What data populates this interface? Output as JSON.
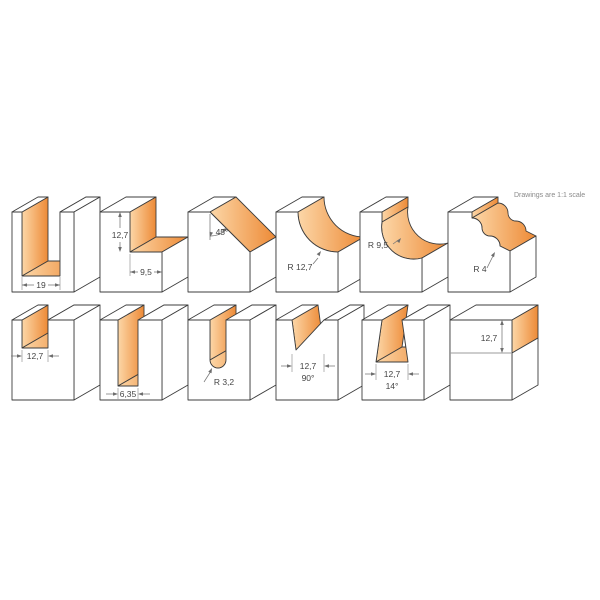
{
  "note": "Drawings are 1:1 scale",
  "colors": {
    "background": "#FFFFFF",
    "cut_gradient_light": "#FCD7A8",
    "cut_gradient_dark": "#ED8A36",
    "cut_dark_flank_light": "#F3A160",
    "cut_dark_flank_dark": "#E87E24",
    "outline": "#3D3D3D",
    "dimension_lines": "#757575",
    "label_text": "#454545",
    "note_text": "#8A8A8A"
  },
  "profiles": [
    {
      "shape": "straight-groove",
      "dims": [
        "19"
      ]
    },
    {
      "shape": "rabbet-step",
      "dims": [
        "12,7",
        "9,5"
      ]
    },
    {
      "shape": "chamfer-45",
      "dims": [
        "45°"
      ]
    },
    {
      "shape": "cove",
      "dims": [
        "R 12,7"
      ]
    },
    {
      "shape": "cove-with-fillet",
      "dims": [
        "R 9,5"
      ]
    },
    {
      "shape": "classical-ogee",
      "dims": [
        "R 4"
      ]
    },
    {
      "shape": "dado-groove",
      "dims": [
        "12,7"
      ]
    },
    {
      "shape": "deep-narrow-slot",
      "dims": [
        "6,35"
      ]
    },
    {
      "shape": "round-nose-groove",
      "dims": [
        "R 3,2"
      ]
    },
    {
      "shape": "v-groove",
      "dims": [
        "12,7",
        "90°"
      ]
    },
    {
      "shape": "dovetail-groove",
      "dims": [
        "12,7",
        "14°"
      ]
    },
    {
      "shape": "edge-cut-depth",
      "dims": [
        "12,7"
      ]
    }
  ]
}
